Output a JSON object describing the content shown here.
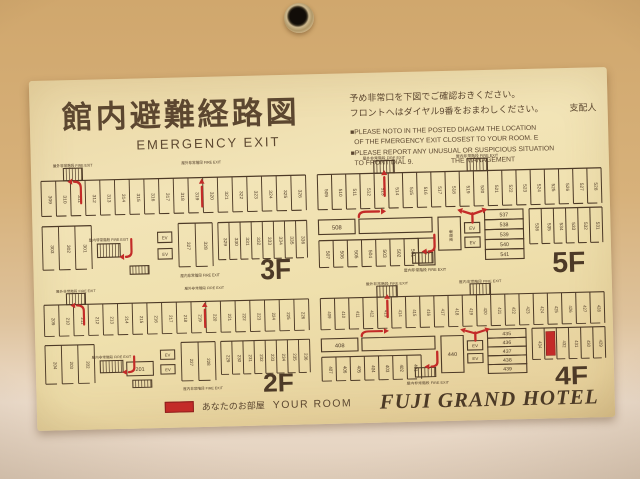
{
  "sign": {
    "title_jp": "館内避難経路図",
    "title_en": "EMERGENCY EXIT",
    "notice": {
      "jp_line1": "予め非常口を下図でご確認おきください。",
      "jp_line2": "フロントへはダイヤル9番をおまわしください。",
      "signer": "支配人",
      "en_lines": [
        "■PLEASE NOTO IN THE POSTED DIAGAM THE LOCATION",
        "  OF THE FMERGENCY EXIT CLOSEST TO YOUR ROOM. E",
        "■PLEASE REPORT ANY UNUSUAL OR SUSPICIOUS SITUATION",
        "  TO FRONT DIAL 9.                    THE MANAGEMENT"
      ]
    },
    "labels": {
      "fire_exit_en": "FIRE EXIT",
      "outdoor_jp": "屋外非常階段",
      "indoor_jp": "屋内非常階段",
      "elevator": "EV",
      "wc": "WC",
      "office_jp": "事務室"
    },
    "legend": {
      "jp": "あなたのお部屋",
      "en": "YOUR ROOM",
      "swatch_color": "#c32b28"
    },
    "hotel_name": "FUJI GRAND HOTEL",
    "floors": [
      {
        "name": "3F",
        "type": "lower",
        "top_rooms": [
          "309",
          "310",
          "311",
          "312",
          "313",
          "314",
          "315",
          "316",
          "317",
          "318",
          "319",
          "320",
          "321",
          "322",
          "323",
          "324",
          "325",
          "326"
        ],
        "bottom_left_rooms": [
          "303",
          "302",
          "301"
        ],
        "mid_rooms": [
          "327",
          "328"
        ],
        "right_rooms": [
          "329",
          "330",
          "331",
          "332",
          "333",
          "334",
          "335",
          "336"
        ],
        "wide_room": null,
        "top_exit_keys": [
          "outdoor",
          "outdoor"
        ],
        "bottom_exit_key": "indoor"
      },
      {
        "name": "5F",
        "type": "upper",
        "left_room": "508",
        "top_rooms": [
          "509",
          "510",
          "511",
          "512",
          "513",
          "514",
          "515",
          "516",
          "517",
          "518",
          "519",
          "520",
          "521",
          "522",
          "523",
          "524",
          "525",
          "526",
          "527",
          "528"
        ],
        "bottom_left_rooms": [
          "507",
          "506",
          "505",
          "504",
          "503",
          "502",
          "501"
        ],
        "wc": true,
        "center_room": null,
        "stacked_rooms": [
          "537",
          "538",
          "539",
          "540",
          "541"
        ],
        "right_wing_rooms": [
          "536",
          "535",
          "534",
          "533",
          "532",
          "531"
        ],
        "your_room": null,
        "top_exit_keys": [
          "outdoor",
          "indoor"
        ],
        "bottom_exit_key": "indoor"
      },
      {
        "name": "2F",
        "type": "lower",
        "top_rooms": [
          "209",
          "210",
          "211",
          "212",
          "213",
          "214",
          "215",
          "216",
          "217",
          "218",
          "219",
          "220",
          "221",
          "222",
          "223",
          "224",
          "225",
          "226"
        ],
        "bottom_left_rooms": [
          "204",
          "203",
          "202"
        ],
        "mid_rooms": [
          "227",
          "228"
        ],
        "right_rooms": [
          "229",
          "230",
          "231",
          "232",
          "233",
          "234",
          "235",
          "236"
        ],
        "wide_room": "201",
        "top_exit_keys": [
          "outdoor",
          "outdoor"
        ],
        "bottom_exit_key": "indoor"
      },
      {
        "name": "4F",
        "type": "upper",
        "left_room": "408",
        "top_rooms": [
          "409",
          "410",
          "411",
          "412",
          "413",
          "414",
          "415",
          "416",
          "417",
          "418",
          "419",
          "420",
          "421",
          "422",
          "423",
          "424",
          "425",
          "426",
          "427",
          "428"
        ],
        "bottom_left_rooms": [
          "407",
          "406",
          "405",
          "404",
          "403",
          "402",
          "401"
        ],
        "wc": false,
        "center_room": "440",
        "stacked_rooms": [
          "435",
          "436",
          "437",
          "438",
          "439"
        ],
        "right_wing_rooms": [
          "434",
          "433",
          "432",
          "431",
          "430",
          "429"
        ],
        "your_room": "433",
        "top_exit_keys": [
          "outdoor",
          "indoor"
        ],
        "bottom_exit_key": "indoor"
      }
    ]
  },
  "colors": {
    "wall_top": "#d0a76d",
    "wall_bottom": "#ecdccb",
    "sign_bg": "#efe0ad",
    "plan_line": "#4d3a27",
    "title_text": "#5c4730",
    "accent_red": "#c32b28"
  }
}
